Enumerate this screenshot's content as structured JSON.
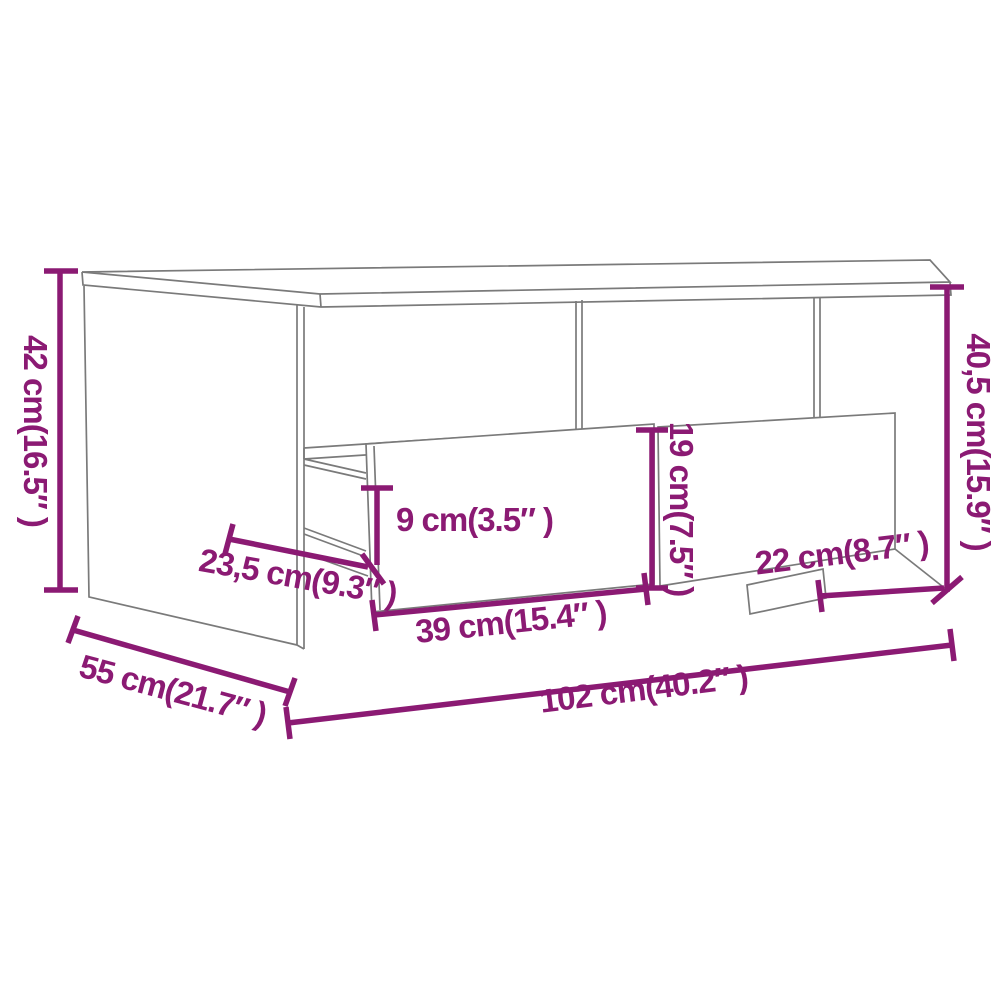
{
  "diagram": {
    "title": "Coffee table dimension diagram",
    "subject": "coffee table with two drawers and open shelf",
    "units": "cm and inches",
    "colors": {
      "dimension_annotation": "#8b1a73",
      "furniture_outline": "#7a7a7a",
      "background": "#ffffff"
    },
    "dimensions": {
      "overall_height": "42 cm(16.5″ )",
      "side_height": "40,5 cm(15.9″ )",
      "drawer_front_height": "19 cm(7.5″ )",
      "drawer_opening_height": "9 cm(3.5″ )",
      "drawer_inner_depth": "23,5 cm(9.3″ )",
      "drawer_width": "39 cm(15.4″ )",
      "compartment_width": "22 cm(8.7″ )",
      "overall_depth": "55 cm(21.7″ )",
      "overall_width": "102 cm(40.2″ )"
    }
  }
}
